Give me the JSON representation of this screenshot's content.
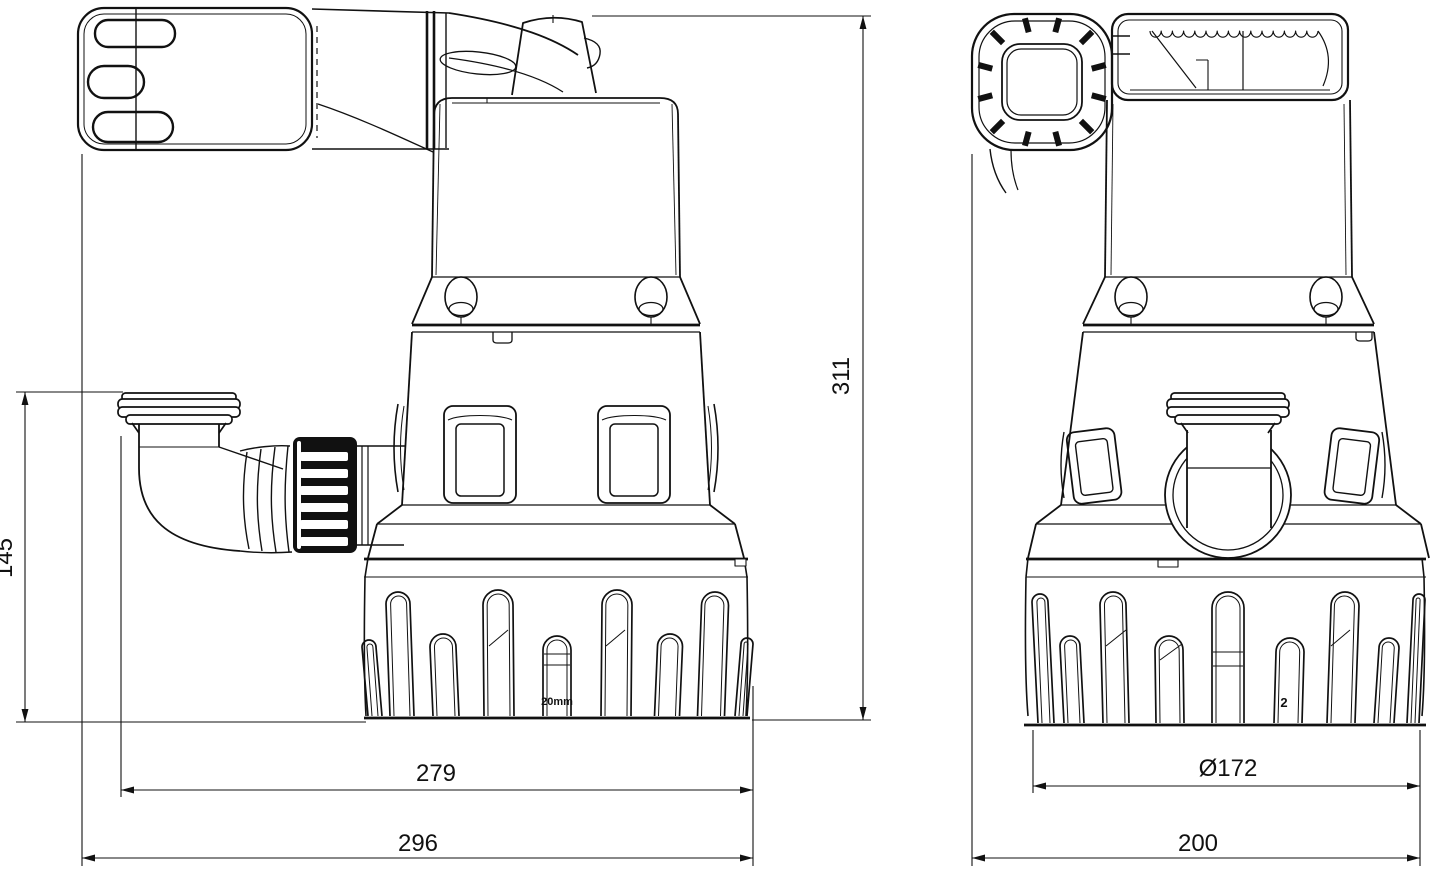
{
  "drawing": {
    "type": "technical-dimension-drawing",
    "subject": "submersible drainage pump, two orthographic views",
    "views": {
      "front": "front view with elbow outlet",
      "side": "side view with coupling nut"
    }
  },
  "dimensions": {
    "overall_height_mm": "311",
    "outlet_height_mm": "145",
    "body_width_mm": "279",
    "overall_width_mm": "296",
    "strainer_diameter": "Ø172",
    "overall_depth_mm": "200"
  },
  "markings": {
    "strainer_front": "20mm",
    "strainer_side": "2"
  },
  "colors": {
    "line": "#111111",
    "background": "#ffffff"
  }
}
